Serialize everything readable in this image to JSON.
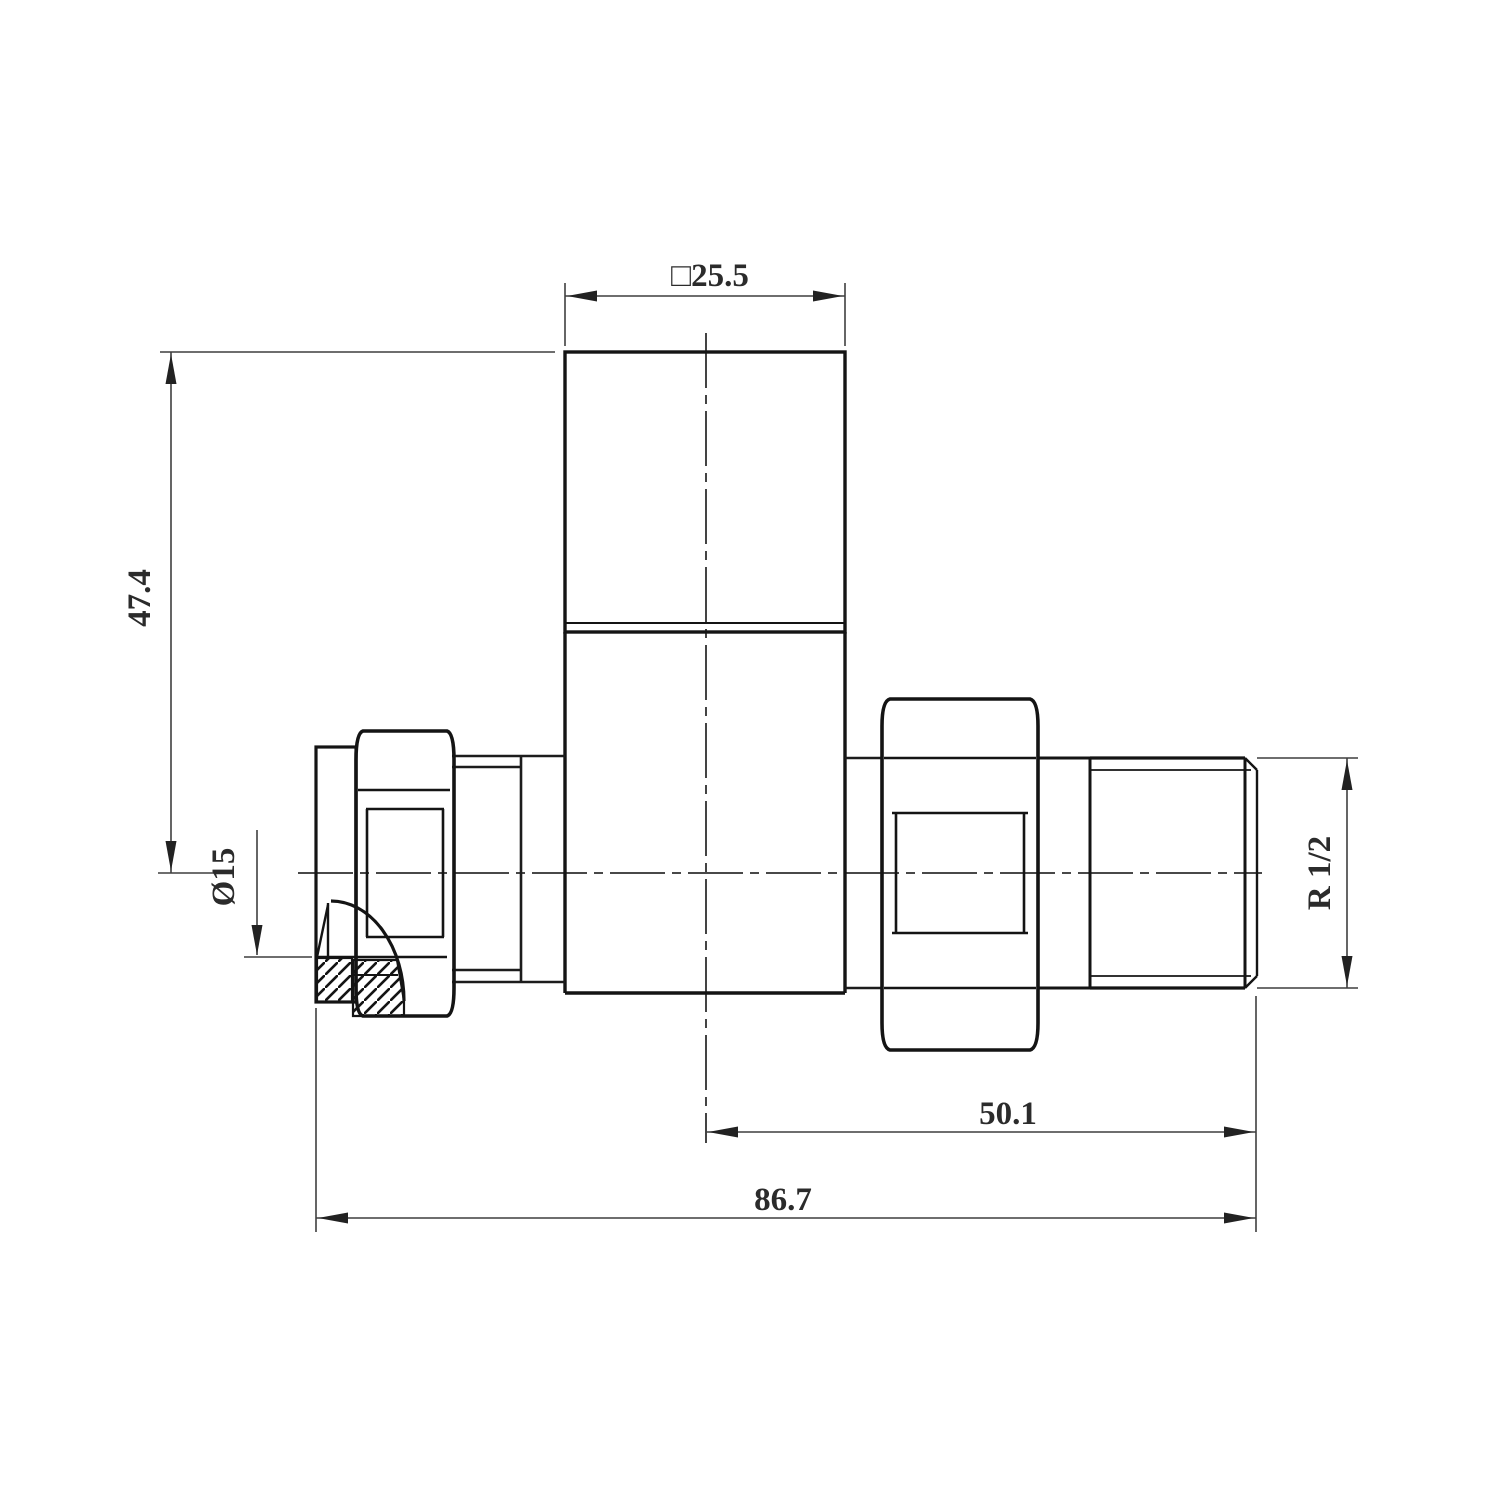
{
  "drawing": {
    "type": "engineering-drawing",
    "subject": "straight radiator valve side elevation",
    "dimensions": {
      "head_width": {
        "label": "□25.5"
      },
      "height": {
        "label": "47.4"
      },
      "bore_diameter": {
        "label": "Ø15"
      },
      "thread_size": {
        "label": "R 1/2"
      },
      "center_to_end": {
        "label": "50.1"
      },
      "overall_length": {
        "label": "86.7"
      }
    },
    "colors": {
      "outline": "#141414",
      "feature_line": "#1c1c1c",
      "dimension_line": "#3f3f3f",
      "center_line": "#2f2f2f",
      "background": "#ffffff"
    }
  }
}
